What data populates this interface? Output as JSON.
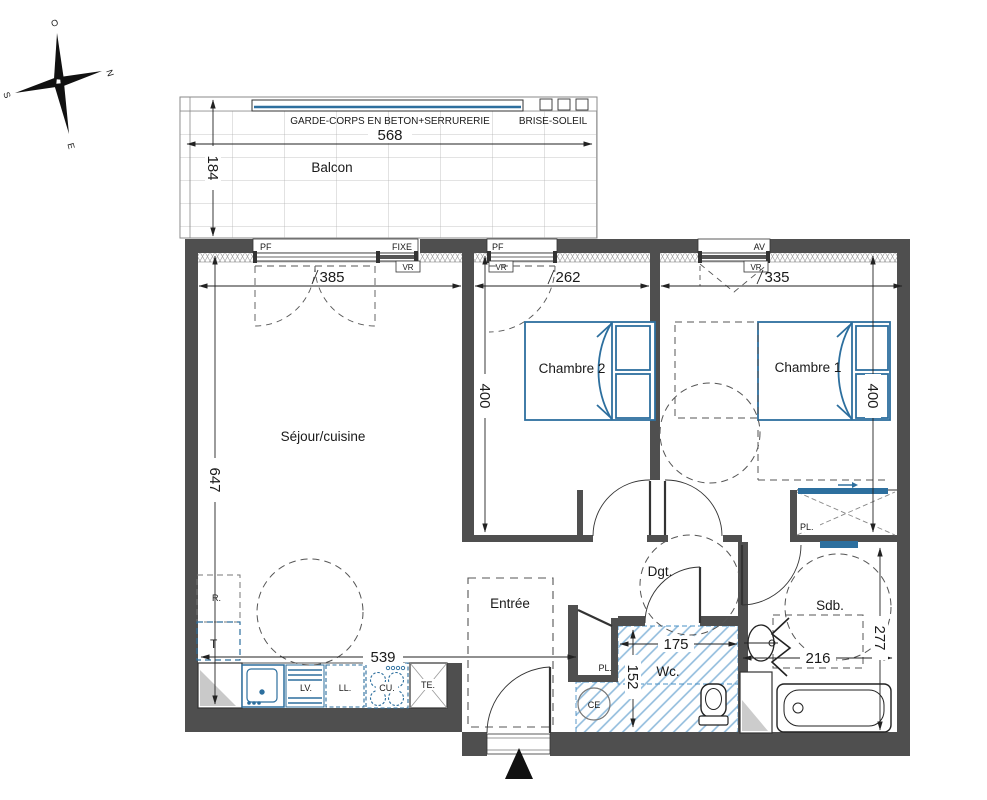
{
  "colors": {
    "wall": "#4f4f4f",
    "fixture_blue": "#2d6f9e",
    "hatch_blue": "#8fbbdc",
    "dash_gray": "#5a5a5a",
    "entrance_marker": "#111111"
  },
  "compass": {
    "west": "O",
    "north": "N",
    "south": "S",
    "east": "E"
  },
  "balcony": {
    "label": "Balcon",
    "railing": "GARDE-CORPS EN BETON+SERRURERIE",
    "sunshade": "BRISE-SOLEIL",
    "dim_width": "568",
    "dim_depth": "184"
  },
  "windows": {
    "pf": "PF",
    "fixe": "FIXE",
    "vr": "VR",
    "av": "AV"
  },
  "rooms": {
    "living": "Séjour/cuisine",
    "bed2": "Chambre 2",
    "bed1": "Chambre 1",
    "entry": "Entrée",
    "hall": "Dgt.",
    "wc": "Wc.",
    "bath": "Sdb."
  },
  "dims": {
    "living_window": "385",
    "bed2_window": "262",
    "bed1_window": "335",
    "living_height": "647",
    "living_width": "539",
    "bed2_depth": "400",
    "bed1_depth": "400",
    "wc_width": "175",
    "wc_depth": "152",
    "bath_width": "216",
    "bath_depth": "277"
  },
  "fixtures": {
    "fridge": "R.",
    "table": "T",
    "dishwasher": "LV.",
    "washer": "LL.",
    "cooktop": "CU.",
    "elec_panel": "TE.",
    "water_heater": "CE",
    "closet": "PL."
  }
}
